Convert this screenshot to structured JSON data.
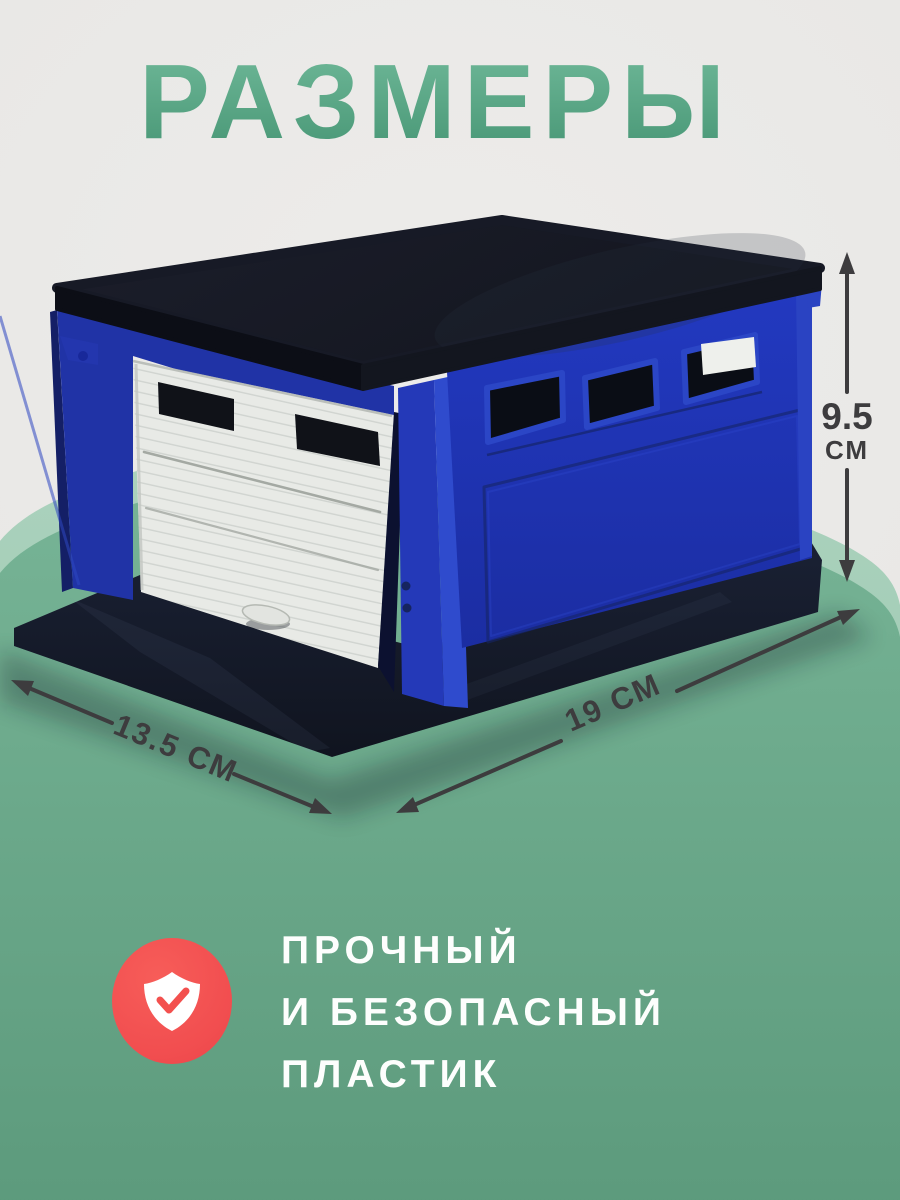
{
  "title": "РАЗМЕРЫ",
  "dimensions": {
    "height_value": "9.5",
    "height_unit": "СМ",
    "width_label": "19 СМ",
    "depth_label": "13.5 СМ"
  },
  "features": {
    "line1": "ПРОЧНЫЙ",
    "line2": "И БЕЗОПАСНЫЙ",
    "line3": "ПЛАСТИК"
  },
  "icons": {
    "badge": "shield-check-icon"
  },
  "colors": {
    "title_green": "#55a382",
    "blob_green": "#6fae8f",
    "blob_green_light": "#a6cfba",
    "badge_red": "#f3504e",
    "garage_blue": "#1e34b0",
    "garage_door_white": "#e8eae6",
    "roof_navy": "#14171f",
    "dimension_text": "#3d3c3e",
    "feature_text": "#ffffff",
    "background_gray": "#e9e8e6"
  }
}
